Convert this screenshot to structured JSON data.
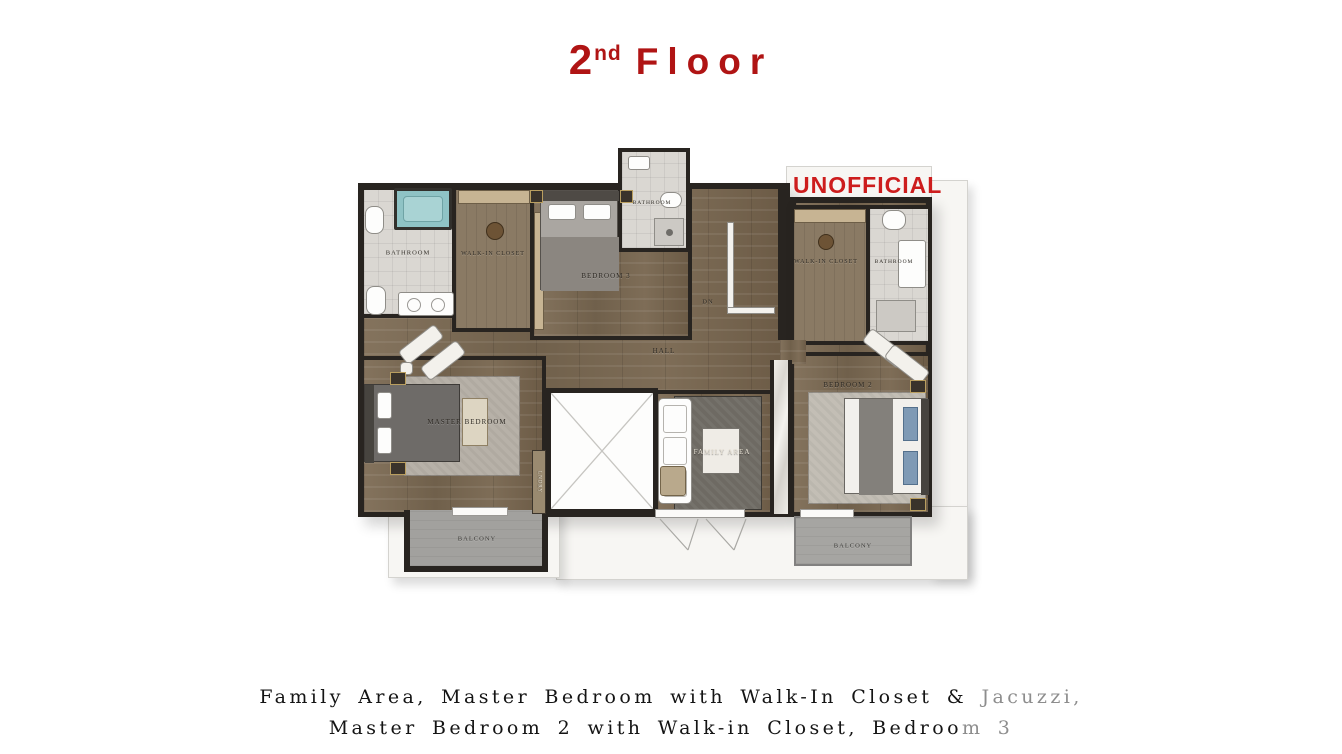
{
  "title": {
    "number": "2",
    "ordinal": "nd",
    "word": "Floor"
  },
  "watermark": "UNOFFICIAL",
  "rooms": {
    "master_bathroom": {
      "label": "BATHROOM"
    },
    "walk_in_closet_left": {
      "label": "WALK-IN CLOSET"
    },
    "bedroom_3": {
      "label": "BEDROOM 3"
    },
    "bathroom_small": {
      "label": "BATHROOM"
    },
    "stairs_dn": {
      "label": "DN"
    },
    "hall": {
      "label": "HALL"
    },
    "walk_in_closet_right": {
      "label": "WALK-IN CLOSET"
    },
    "bathroom_right": {
      "label": "BATHROOM"
    },
    "master_bedroom": {
      "label": "MASTER BEDROOM"
    },
    "laundry": {
      "label": "LNDRY"
    },
    "family_area": {
      "label": "FAMILY AREA"
    },
    "bedroom_2": {
      "label": "BEDROOM 2"
    },
    "balcony_left": {
      "label": "BALCONY"
    },
    "balcony_right": {
      "label": "BALCONY"
    }
  },
  "caption": {
    "line1_main": "Family Area, Master Bedroom with Walk-In Closet & ",
    "line1_muted": "Jacuzzi,",
    "line2_main": "Master Bedroom 2 with Walk-in Closet, Bedroo",
    "line2_muted": "m 3"
  },
  "colors": {
    "accent_red": "#b01414",
    "watermark_red": "#cd1d1d",
    "wood_floor": "#7c6b55",
    "wall": "#282420",
    "bathroom_tile": "#dad7d2",
    "balcony_grey": "#a2a19e",
    "closet_shelf": "#c7b493",
    "jacuzzi_teal": "#8fc3c5",
    "terrace_white": "#f7f6f3",
    "marble": "#ebe8e3"
  }
}
